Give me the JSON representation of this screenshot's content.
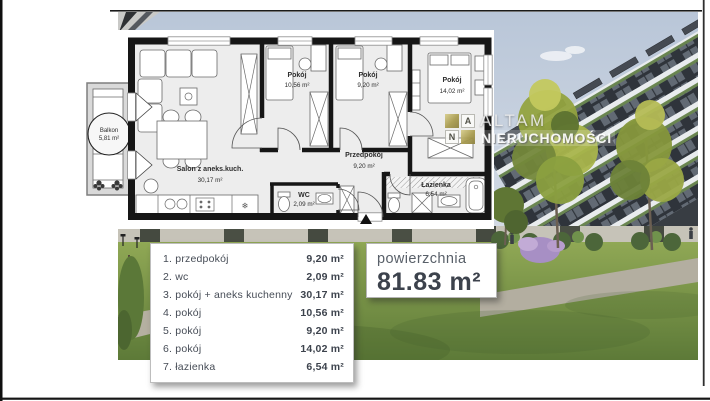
{
  "branding": {
    "company_line1": "ALTAM",
    "company_line2": "NIERUCHOMOŚCI",
    "monogram_a": "A",
    "monogram_n": "N"
  },
  "colors": {
    "logo_gold": "#ab9e54",
    "wall_black": "#161616",
    "text_dark": "#3d434d"
  },
  "floor_plan": {
    "rooms": [
      {
        "name": "Balkon",
        "area": "5,81 m²"
      },
      {
        "name": "Pokój",
        "area": "10,56 m²"
      },
      {
        "name": "Pokój",
        "area": "9,20 m²"
      },
      {
        "name": "Pokój",
        "area": "14,02 m²"
      },
      {
        "name": "Przedpokój",
        "area": "9,20 m²"
      },
      {
        "name": "Salon z aneks.kuch.",
        "area": "30,17 m²"
      },
      {
        "name": "WC",
        "area": "2,09 m²"
      },
      {
        "name": "Łazienka",
        "area": "6,54 m²"
      }
    ],
    "icons": {
      "freeze_symbol": "❄"
    }
  },
  "legend": {
    "rows": [
      {
        "label": "1. przedpokój",
        "value": "9,20 m²"
      },
      {
        "label": "2. wc",
        "value": "2,09 m²"
      },
      {
        "label": "3. pokój + aneks kuchenny",
        "value": "30,17 m²"
      },
      {
        "label": "4. pokój",
        "value": "10,56 m²"
      },
      {
        "label": "5. pokój",
        "value": "9,20 m²"
      },
      {
        "label": "6. pokój",
        "value": "14,02 m²"
      },
      {
        "label": "7. łazienka",
        "value": "6,54 m²"
      }
    ]
  },
  "summary": {
    "label": "powierzchnia",
    "value": "81.83 m²"
  }
}
